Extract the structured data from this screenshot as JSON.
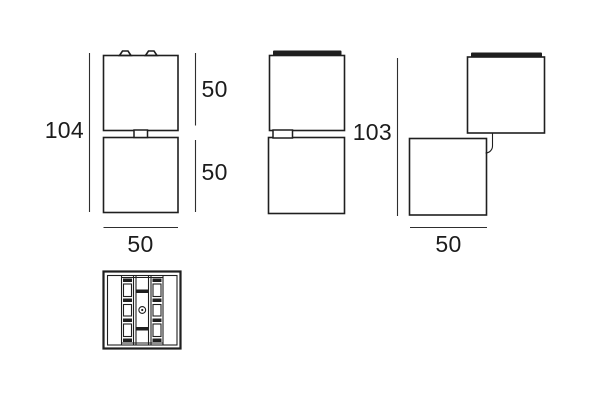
{
  "colors": {
    "background": "#ffffff",
    "line": "#1f1f1f",
    "dimension_line": "#2e2e2e",
    "text": "#1c1c1c"
  },
  "views": {
    "front": {
      "total_height": "104",
      "top_module_height": "50",
      "bottom_module_height": "50",
      "width": "50"
    },
    "articulated": {
      "total_height": "103",
      "width": "50"
    }
  }
}
